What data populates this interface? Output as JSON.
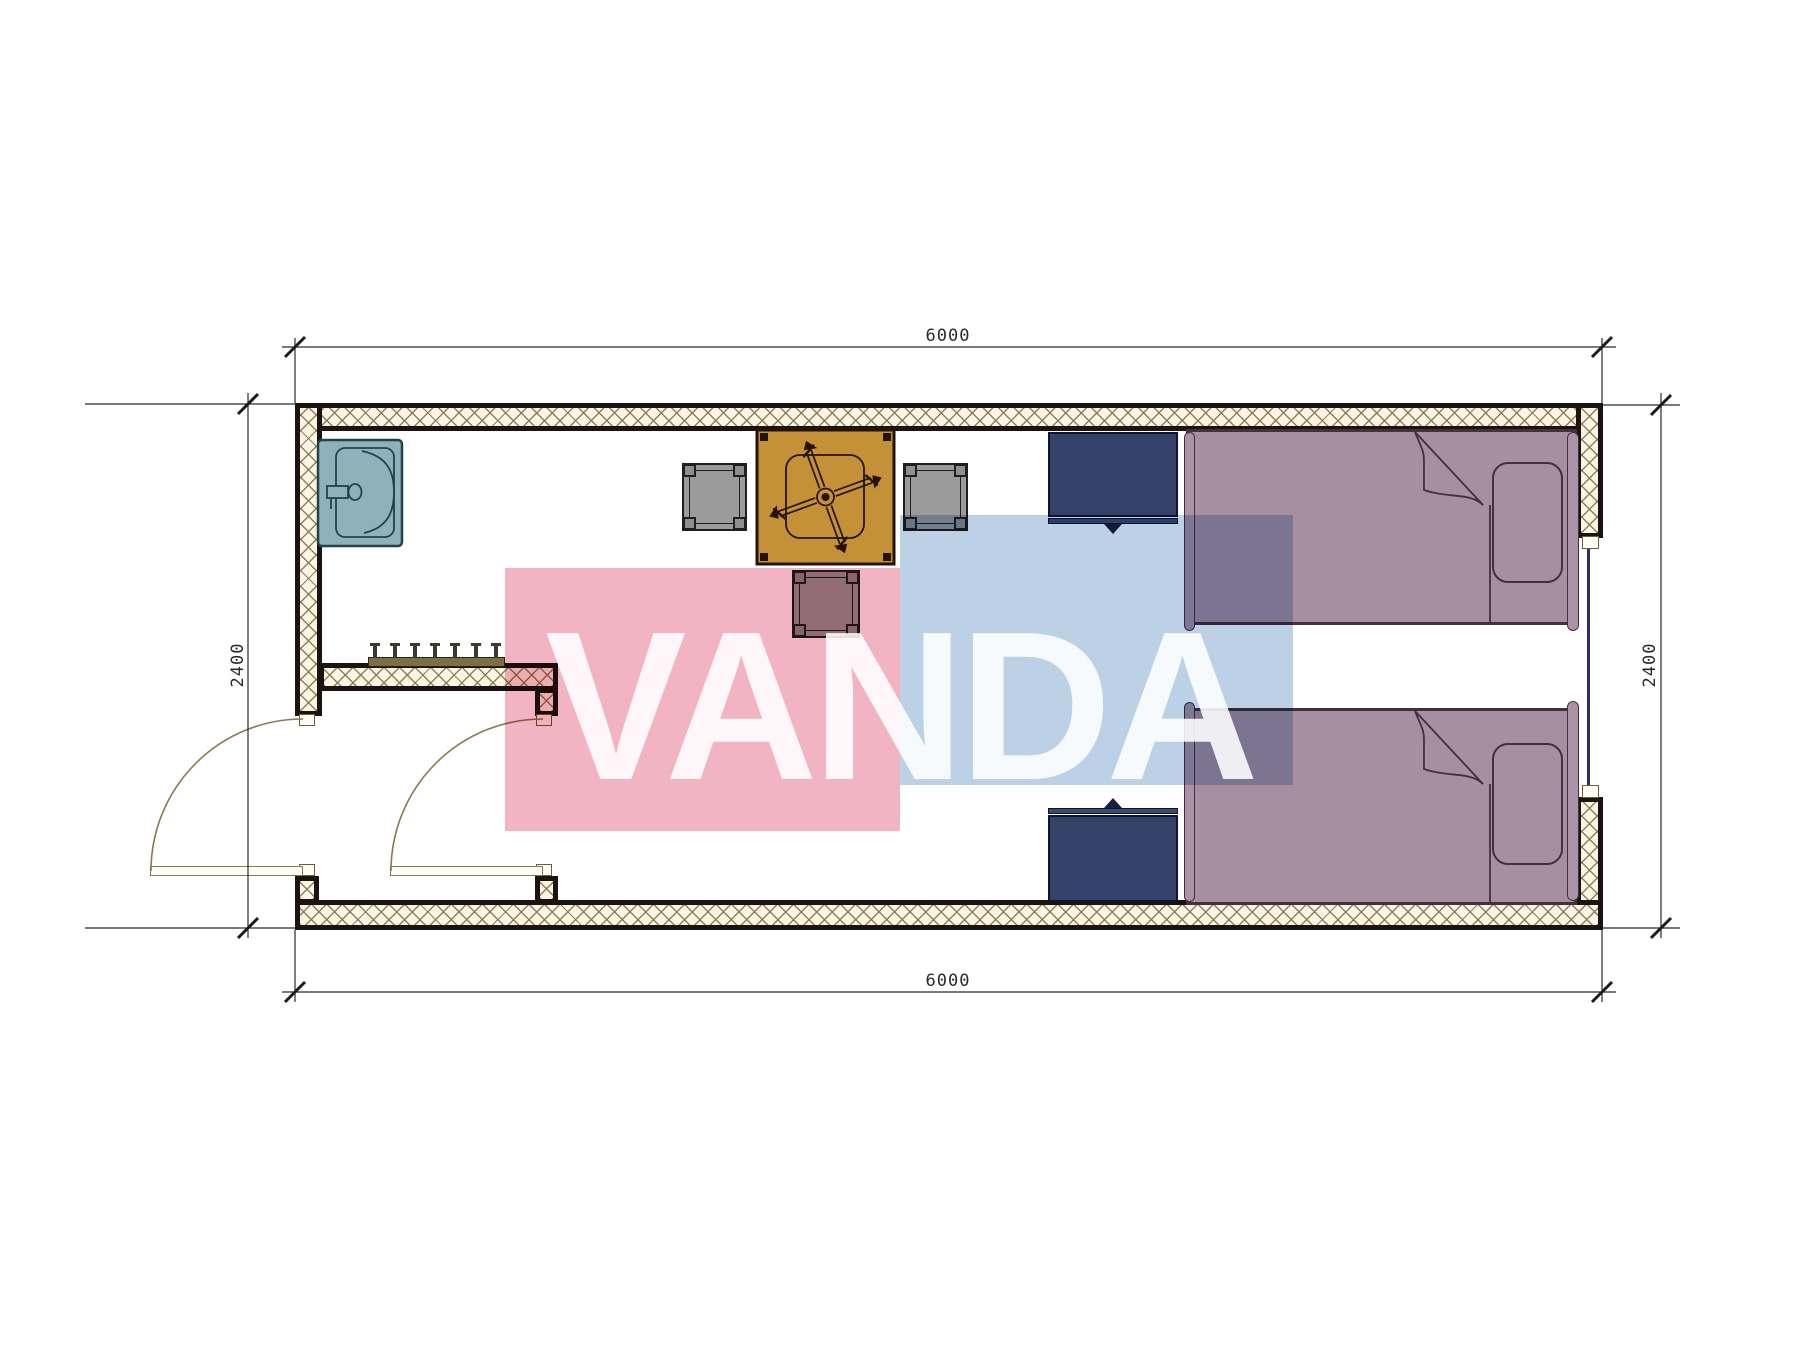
{
  "drawing": {
    "kind": "floor-plan",
    "dimensions": {
      "top": "6000",
      "bottom": "6000",
      "left": "2400",
      "right": "2400"
    },
    "watermark": {
      "text": "VANDA",
      "pink_color": "#f2b3c2",
      "blue_color": "#bcd0e6",
      "text_color": "rgba(255,255,255,0.88)"
    },
    "palette": {
      "wall_outline": "#1c1210",
      "wall_hatch_line": "#8b7a50",
      "wall_fill": "#faf5e4",
      "sink": "#8fb1ba",
      "table": "#c49038",
      "chair": "#9b9b9b",
      "nightstand": "#344269",
      "bed": "#a78fa2",
      "window_glass": "#2d2d6b",
      "door_swing": "#8a7a50",
      "dimension_line": "#2a2a2a"
    }
  }
}
